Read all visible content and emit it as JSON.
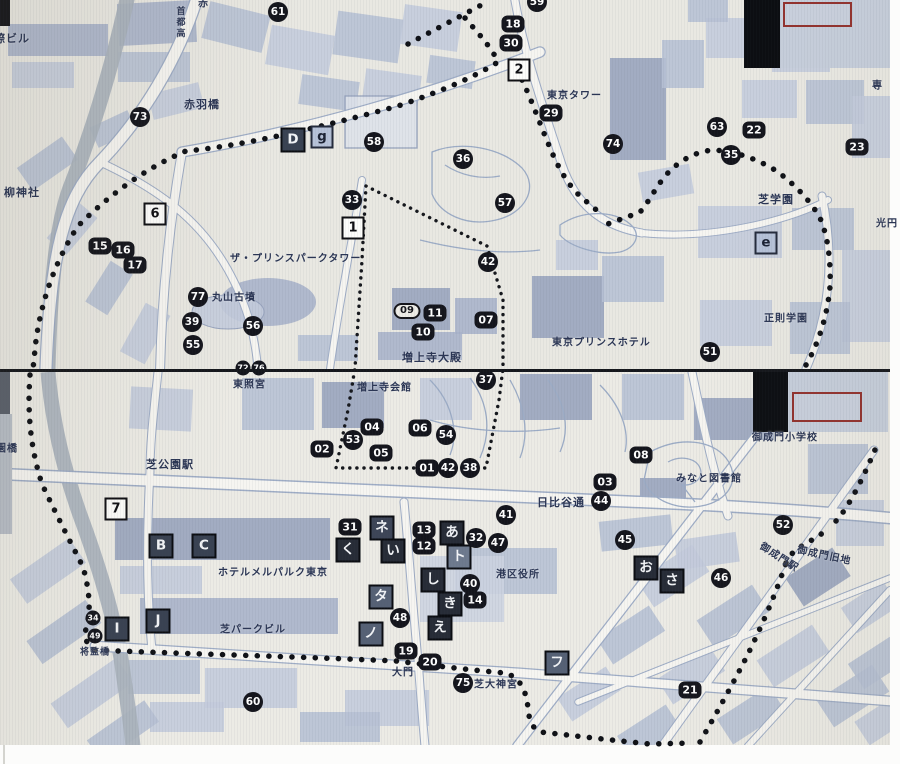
{
  "colors": {
    "paper": "#e9e8e2",
    "buildings": "#b6c0d4",
    "buildings_dark": "#97a3bd",
    "river": "#aab3bc",
    "route_dots": "#0f1116",
    "marker_circle": "#14151c",
    "marker_letter_dark": "#394252",
    "letter_square_light": "#b6c2d8",
    "marker_white_square": "#fdfdfb",
    "inset_frame_red": "#93322e",
    "label_text": "#2a3554"
  },
  "photos": [
    {
      "id": "top",
      "labels": [
        {
          "text": "際ビル",
          "x": -6,
          "y": 38,
          "size": 11
        },
        {
          "text": "首都高",
          "x": 180,
          "y": 6,
          "size": 9,
          "vertical": true
        },
        {
          "text": "赤",
          "x": 198,
          "y": 2,
          "size": 10
        },
        {
          "text": "赤羽橋",
          "x": 184,
          "y": 104,
          "size": 11
        },
        {
          "text": "柳神社",
          "x": 4,
          "y": 192,
          "size": 11
        },
        {
          "text": "東京タワー",
          "x": 547,
          "y": 94,
          "size": 10
        },
        {
          "text": "ザ・プリンスパークタワー",
          "x": 230,
          "y": 257,
          "size": 10
        },
        {
          "text": "丸山古墳",
          "x": 212,
          "y": 296,
          "size": 10
        },
        {
          "text": "増上寺大殿",
          "x": 402,
          "y": 357,
          "size": 11
        },
        {
          "text": "東京プリンスホテル",
          "x": 552,
          "y": 341,
          "size": 10
        },
        {
          "text": "芝学園",
          "x": 758,
          "y": 199,
          "size": 11
        },
        {
          "text": "正則学園",
          "x": 764,
          "y": 317,
          "size": 10
        },
        {
          "text": "光円",
          "x": 876,
          "y": 222,
          "size": 10
        },
        {
          "text": "専",
          "x": 872,
          "y": 84,
          "size": 10
        }
      ],
      "markers": [
        {
          "label": "73",
          "type": "c",
          "x": 140,
          "y": 117
        },
        {
          "label": "61",
          "type": "c",
          "x": 278,
          "y": 12
        },
        {
          "label": "59",
          "type": "c",
          "x": 537,
          "y": 2
        },
        {
          "label": "58",
          "type": "c",
          "x": 374,
          "y": 142
        },
        {
          "label": "36",
          "type": "c",
          "x": 463,
          "y": 159
        },
        {
          "label": "29",
          "type": "r",
          "x": 551,
          "y": 113
        },
        {
          "label": "18",
          "type": "r",
          "x": 513,
          "y": 24
        },
        {
          "label": "30",
          "type": "r",
          "x": 511,
          "y": 43
        },
        {
          "label": "2",
          "type": "w",
          "x": 519,
          "y": 70
        },
        {
          "label": "74",
          "type": "c",
          "x": 613,
          "y": 144
        },
        {
          "label": "63",
          "type": "c",
          "x": 717,
          "y": 127
        },
        {
          "label": "22",
          "type": "r",
          "x": 754,
          "y": 130
        },
        {
          "label": "23",
          "type": "r",
          "x": 857,
          "y": 147
        },
        {
          "label": "35",
          "type": "c",
          "x": 731,
          "y": 155
        },
        {
          "label": "33",
          "type": "c",
          "x": 352,
          "y": 200
        },
        {
          "label": "57",
          "type": "c",
          "x": 505,
          "y": 203
        },
        {
          "label": "42",
          "type": "c",
          "x": 488,
          "y": 262
        },
        {
          "label": "77",
          "type": "c",
          "x": 198,
          "y": 297
        },
        {
          "label": "39",
          "type": "c",
          "x": 192,
          "y": 322
        },
        {
          "label": "55",
          "type": "c",
          "x": 193,
          "y": 345
        },
        {
          "label": "56",
          "type": "c",
          "x": 253,
          "y": 326
        },
        {
          "label": "51",
          "type": "c",
          "x": 710,
          "y": 352
        },
        {
          "label": "6",
          "type": "w",
          "x": 155,
          "y": 214
        },
        {
          "label": "1",
          "type": "w",
          "x": 353,
          "y": 228
        },
        {
          "label": "15",
          "type": "r",
          "x": 100,
          "y": 246
        },
        {
          "label": "16",
          "type": "r",
          "x": 123,
          "y": 250
        },
        {
          "label": "17",
          "type": "r",
          "x": 135,
          "y": 265
        },
        {
          "label": "09",
          "type": "o",
          "x": 407,
          "y": 311
        },
        {
          "label": "11",
          "type": "r",
          "x": 435,
          "y": 313
        },
        {
          "label": "10",
          "type": "r",
          "x": 423,
          "y": 332
        },
        {
          "label": "07",
          "type": "r",
          "x": 486,
          "y": 320
        },
        {
          "label": "D",
          "type": "d",
          "x": 293,
          "y": 140,
          "shade": "#394252"
        },
        {
          "label": "g",
          "type": "l",
          "x": 322,
          "y": 137
        },
        {
          "label": "e",
          "type": "l",
          "x": 766,
          "y": 243
        },
        {
          "label": "72",
          "type": "cs",
          "x": 243,
          "y": 368
        },
        {
          "label": "76",
          "type": "cs",
          "x": 259,
          "y": 368
        }
      ]
    },
    {
      "id": "bottom",
      "labels": [
        {
          "text": "東照宮",
          "x": 233,
          "y": 383,
          "size": 10
        },
        {
          "text": "増上寺会館",
          "x": 357,
          "y": 386,
          "size": 10
        },
        {
          "text": "園橋",
          "x": -4,
          "y": 447,
          "size": 10
        },
        {
          "text": "芝公園駅",
          "x": 146,
          "y": 464,
          "size": 11
        },
        {
          "text": "日比谷通",
          "x": 537,
          "y": 502,
          "size": 11
        },
        {
          "text": "みなと図書館",
          "x": 676,
          "y": 477,
          "size": 10
        },
        {
          "text": "御成門小学校",
          "x": 752,
          "y": 436,
          "size": 10
        },
        {
          "text": "御成門旧地",
          "x": 797,
          "y": 554,
          "size": 10,
          "rot": 12
        },
        {
          "text": "御成門駅",
          "x": 758,
          "y": 556,
          "size": 10,
          "rot": 33
        },
        {
          "text": "ホテルメルパルク東京",
          "x": 218,
          "y": 571,
          "size": 10
        },
        {
          "text": "芝パークビル",
          "x": 220,
          "y": 628,
          "size": 10
        },
        {
          "text": "将監橋",
          "x": 80,
          "y": 651,
          "size": 9
        },
        {
          "text": "大門",
          "x": 392,
          "y": 671,
          "size": 10
        },
        {
          "text": "芝大神宮",
          "x": 474,
          "y": 683,
          "size": 10
        },
        {
          "text": "港区役所",
          "x": 496,
          "y": 573,
          "size": 10
        }
      ],
      "markers": [
        {
          "label": "37",
          "type": "c",
          "x": 486,
          "y": 380
        },
        {
          "label": "04",
          "type": "r",
          "x": 372,
          "y": 427
        },
        {
          "label": "06",
          "type": "r",
          "x": 420,
          "y": 428
        },
        {
          "label": "54",
          "type": "c",
          "x": 446,
          "y": 435
        },
        {
          "label": "53",
          "type": "c",
          "x": 353,
          "y": 440
        },
        {
          "label": "02",
          "type": "r",
          "x": 322,
          "y": 449
        },
        {
          "label": "05",
          "type": "r",
          "x": 381,
          "y": 453
        },
        {
          "label": "01",
          "type": "r",
          "x": 427,
          "y": 468
        },
        {
          "label": "42",
          "type": "c",
          "x": 448,
          "y": 468
        },
        {
          "label": "38",
          "type": "c",
          "x": 470,
          "y": 468
        },
        {
          "label": "08",
          "type": "r",
          "x": 641,
          "y": 455
        },
        {
          "label": "03",
          "type": "r",
          "x": 605,
          "y": 482
        },
        {
          "label": "44",
          "type": "c",
          "x": 601,
          "y": 501
        },
        {
          "label": "41",
          "type": "c",
          "x": 506,
          "y": 515
        },
        {
          "label": "45",
          "type": "c",
          "x": 625,
          "y": 540
        },
        {
          "label": "52",
          "type": "c",
          "x": 783,
          "y": 525
        },
        {
          "label": "31",
          "type": "r",
          "x": 350,
          "y": 527
        },
        {
          "label": "ネ",
          "type": "d",
          "x": 382,
          "y": 528,
          "shade": "#3d4557"
        },
        {
          "label": "13",
          "type": "r",
          "x": 424,
          "y": 530
        },
        {
          "label": "12",
          "type": "r",
          "x": 424,
          "y": 546
        },
        {
          "label": "あ",
          "type": "d",
          "x": 452,
          "y": 533
        },
        {
          "label": "く",
          "type": "d",
          "x": 348,
          "y": 550
        },
        {
          "label": "い",
          "type": "d",
          "x": 393,
          "y": 551
        },
        {
          "label": "ト",
          "type": "d",
          "x": 459,
          "y": 557,
          "shade": "#6e7a8e"
        },
        {
          "label": "32",
          "type": "c",
          "x": 476,
          "y": 538
        },
        {
          "label": "47",
          "type": "c",
          "x": 498,
          "y": 543
        },
        {
          "label": "し",
          "type": "d",
          "x": 433,
          "y": 580
        },
        {
          "label": "40",
          "type": "c",
          "x": 470,
          "y": 584
        },
        {
          "label": "14",
          "type": "r",
          "x": 475,
          "y": 600
        },
        {
          "label": "き",
          "type": "d",
          "x": 450,
          "y": 604
        },
        {
          "label": "え",
          "type": "d",
          "x": 440,
          "y": 628
        },
        {
          "label": "タ",
          "type": "d",
          "x": 381,
          "y": 597,
          "shade": "#566175"
        },
        {
          "label": "48",
          "type": "c",
          "x": 400,
          "y": 618
        },
        {
          "label": "ノ",
          "type": "d",
          "x": 371,
          "y": 634,
          "shade": "#566175"
        },
        {
          "label": "19",
          "type": "r",
          "x": 406,
          "y": 651
        },
        {
          "label": "20",
          "type": "r",
          "x": 430,
          "y": 662
        },
        {
          "label": "75",
          "type": "c",
          "x": 463,
          "y": 683
        },
        {
          "label": "フ",
          "type": "d",
          "x": 557,
          "y": 663,
          "shade": "#566175"
        },
        {
          "label": "お",
          "type": "d",
          "x": 646,
          "y": 568
        },
        {
          "label": "さ",
          "type": "d",
          "x": 672,
          "y": 581
        },
        {
          "label": "46",
          "type": "c",
          "x": 721,
          "y": 578
        },
        {
          "label": "21",
          "type": "r",
          "x": 690,
          "y": 690
        },
        {
          "label": "60",
          "type": "c",
          "x": 253,
          "y": 702
        },
        {
          "label": "B",
          "type": "d",
          "x": 161,
          "y": 546,
          "shade": "#394252"
        },
        {
          "label": "C",
          "type": "d",
          "x": 204,
          "y": 546,
          "shade": "#394252"
        },
        {
          "label": "7",
          "type": "w",
          "x": 116,
          "y": 509
        },
        {
          "label": "I",
          "type": "d",
          "x": 117,
          "y": 629,
          "shade": "#394252"
        },
        {
          "label": "J",
          "type": "d",
          "x": 158,
          "y": 621,
          "shade": "#394252"
        },
        {
          "label": "34",
          "type": "cs",
          "x": 93,
          "y": 618
        },
        {
          "label": "49",
          "type": "cs",
          "x": 95,
          "y": 636
        }
      ]
    }
  ]
}
